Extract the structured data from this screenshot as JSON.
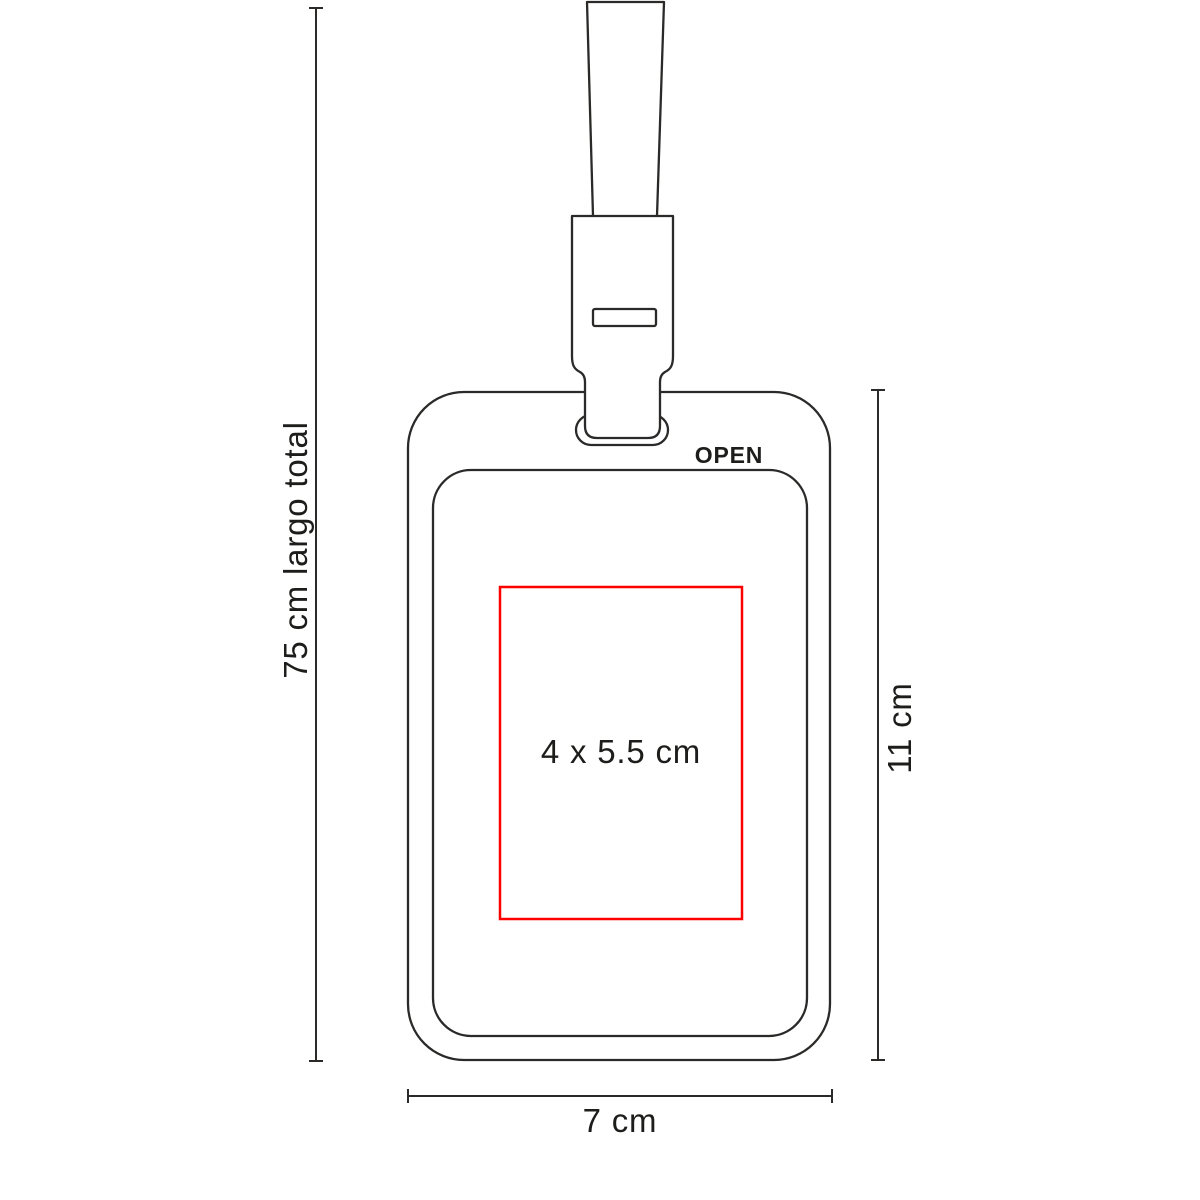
{
  "diagram": {
    "labels": {
      "open": "OPEN",
      "print_area": "4 x 5.5 cm",
      "lanyard_total_length": "75 cm largo total",
      "holder_height": "11 cm",
      "holder_width": "7 cm"
    },
    "colors": {
      "outline": "#2b2a29",
      "print_area_border": "#fe0000",
      "text": "#1d1d1b",
      "background": "#ffffff"
    }
  }
}
